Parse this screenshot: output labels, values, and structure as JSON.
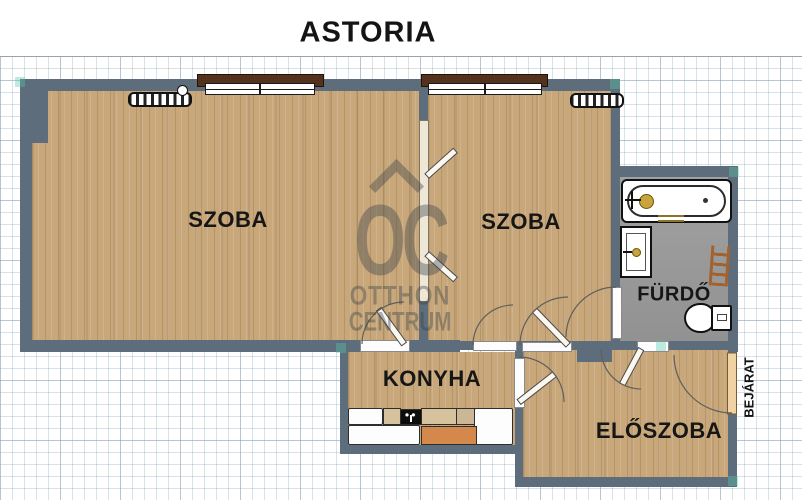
{
  "title": "ASTORIA",
  "rooms": {
    "room_left": "SZOBA",
    "room_right": "SZOBA",
    "bathroom": "FÜRDŐ",
    "kitchen": "KONYHA",
    "hall": "ELŐSZOBA"
  },
  "entrance": {
    "label": "BEJÁRAT"
  },
  "watermark": {
    "monogram": "OC",
    "line1": "OTTHON",
    "line2": "CENTRUM"
  },
  "fixtures": {
    "bathroom": [
      "bathtub",
      "washbasin",
      "toilet",
      "towel-rack"
    ],
    "kitchen": [
      "sink-cabinet",
      "stove",
      "counter",
      "worktable",
      "cabinet"
    ],
    "heating": [
      "radiator-left-room",
      "radiator-right-room"
    ]
  },
  "palette": {
    "wall": "#5d6d7b",
    "wood": "#c8a77a",
    "tile": "#9b9b9b",
    "sill": "#53321e",
    "beige": "#d7c29e",
    "beige2": "#cbb795",
    "orange": "#d4884b",
    "tan": "#f0d2a4",
    "gold": "#c8a43a",
    "brown": "#a2622f"
  }
}
